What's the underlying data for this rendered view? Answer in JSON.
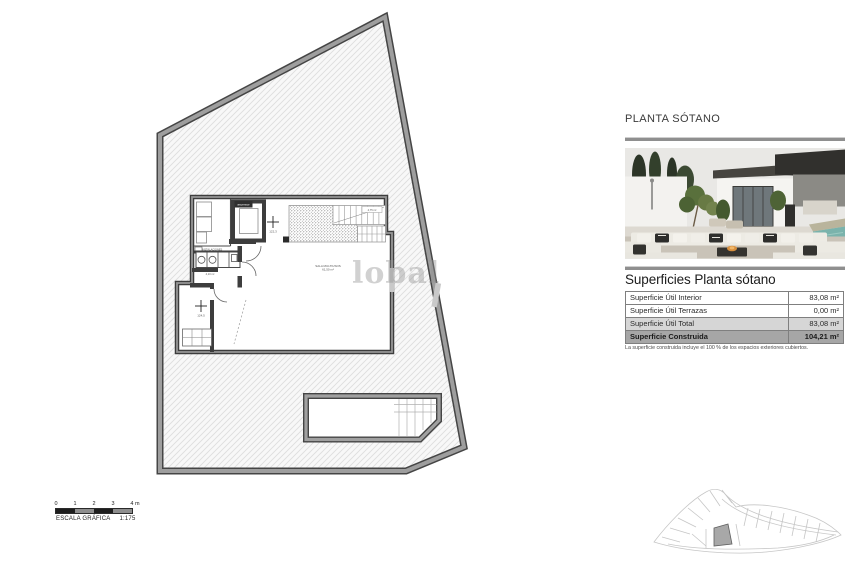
{
  "watermark": {
    "text": "lobal"
  },
  "right_panel": {
    "title": "PLANTA SÓTANO",
    "surfaces": {
      "heading": "Superficies Planta sótano",
      "rows": [
        {
          "label": "Superficie Útil Interior",
          "value": "83,08 m²"
        },
        {
          "label": "Superficie Útil Terrazas",
          "value": "0,00 m²"
        },
        {
          "label": "Superficie Útil Total",
          "value": "83,08 m²"
        },
        {
          "label": "Superficie Construida",
          "value": "104,21 m²"
        }
      ],
      "note": "La superficie construida incluye el 100 % de los espacios exteriores cubiertos."
    }
  },
  "floor_plan": {
    "rooms": {
      "main_room_name": "SALA MULTIUSOS",
      "main_room_area": "61,50 m²",
      "utility_name": "INSTALACIONES",
      "utility_area": "4,50 m²",
      "laundry_name": "LAVADERO",
      "laundry_area": "4,10 m²",
      "stairs_area": "4,75 m²"
    },
    "lift_label": "ascensor",
    "level_markers": [
      {
        "value": "122,3"
      },
      {
        "value": "124,5"
      }
    ]
  },
  "scale_bar": {
    "ticks": [
      "0",
      "1",
      "2",
      "3",
      "4 m"
    ],
    "label": "ESCALA GRÁFICA",
    "ratio": "1:175"
  },
  "colors": {
    "plot_band": "#9e9e9e",
    "plot_edge": "#454545",
    "wall": "#3d3d3d",
    "table_total_bg": "#d6d6d6",
    "table_built_bg": "#a6a6a6",
    "pool_water": "#7ab3ac"
  }
}
